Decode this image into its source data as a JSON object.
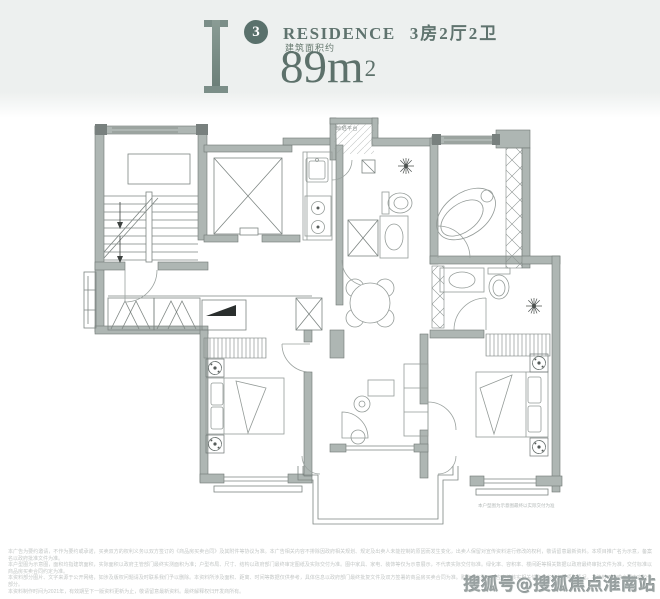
{
  "header": {
    "unit_badge": "3",
    "residence": "RESIDENCE",
    "layout": "3房2厅2卫",
    "area_label": "建筑面积约",
    "area_number": "89m",
    "area_exponent": "2"
  },
  "plan": {
    "platform_label": "晾晒平台",
    "plan_note": "本户型图为示意图最终以实际交付为准"
  },
  "disclaimer": {
    "line1": "本广告为要约邀请，不作为要约或承诺，买卖双方的权利义务以双方签订的《商品房买卖合同》及其附件等协议为准。本广告相关内容不排除因政府相关规划、规定及出卖人未能控制的原因而发生变化，出卖人保留对宣传资料进行修改的权利，敬请留意最新资料。本项目推广名为示意，备案名以政府批准文件为准。",
    "line2": "本户型图为示意图，面积均指建筑面积，实际面积以政府主管部门最终实测面积为准；户型布局、尺寸、结构以政府部门最终审定图纸及实际交付为准。图中家具、家电、装饰等仅为示意展示，不代表实际交付标准。绿化率、容积率、楼间距等相关数据以政府最终审批文件为准，交付标准以商品房买卖合同约定为准。",
    "line3": "本资料部分图片、文字来源于公开网络，如涉及版权问题请及时联系我们予以删除。本资料所涉及面积、距离、时间等数据仅供参考，具体信息以政府部门最终批复文件及双方签署的商品房买卖合同为准。购房者在购买时应审慎核实相关信息，实地查看项目情况，本资料不构成合同内容的一部分。",
    "line4": "本资料制作时间为2021年，有效期至下一版资料更新为止，敬请留意最新资料。最终解释权归开发商所有。"
  },
  "watermark": "搜狐号@搜狐焦点淮南站"
}
